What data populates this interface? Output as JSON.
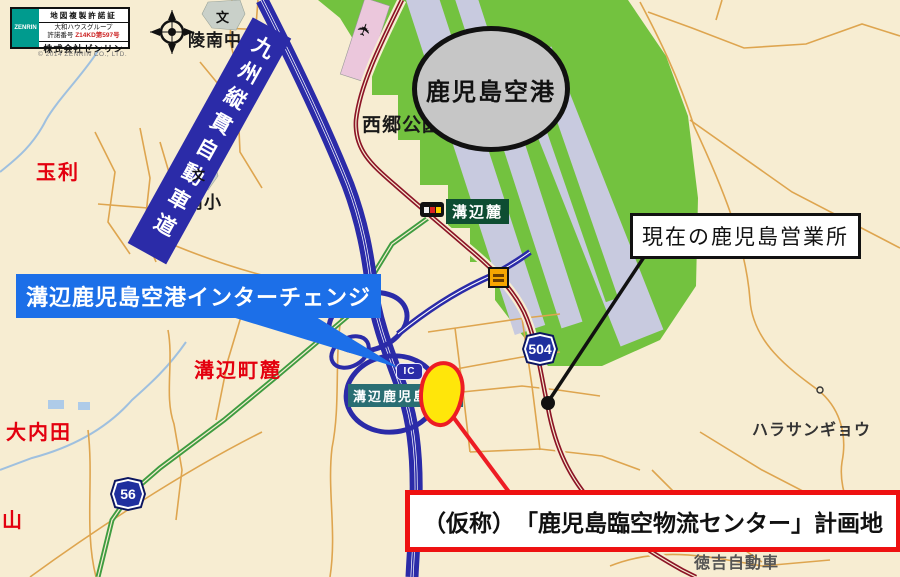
{
  "license_box": {
    "logo": "ZENRIN",
    "title": "地図複製許諾証",
    "group_name": "大和ハウスグループ",
    "license_label": "許諾番号",
    "license_number": "Z14KD第597号",
    "company": "株式会社ゼンリン",
    "copyright": "© 2014 ZENRIN CO., LTD."
  },
  "callouts": {
    "airport": "鹿児島空港",
    "expressway_banner": "九州縦貫自動車道",
    "interchange": "溝辺鹿児島空港インターチェンジ",
    "interchange_map_label": "溝辺鹿児島空港",
    "ic_badge": "IC",
    "current_office": "現在の鹿児島営業所",
    "planned_site": "（仮称）　「鹿児島臨空物流センター」計画地"
  },
  "places": {
    "tamari": "玉利",
    "ryonan_junior_high": "陵南中",
    "ryonan_elementary": "陵南小",
    "saigo_park": "西郷公園",
    "mizobe_fumoto_stop": "溝辺麓",
    "mizobe_cho_fumoto": "溝辺町麓",
    "ouchida": "大内田",
    "yama": "山",
    "hara_sangyo": "ハラサンギョウ",
    "tokuyoshi_jidosha": "徳吉自動車",
    "school_mark": "文"
  },
  "route_shields": {
    "route504": "504",
    "route56": "56"
  },
  "icons": {
    "airplane": "✈"
  },
  "colors": {
    "map_background": "#F7EDD2",
    "airport_green": "#73C23F",
    "runway_gray": "#C8CADF",
    "expressway_blue": "#2B2BA8",
    "callout_blue": "#1C6FE8",
    "site_yellow": "#FFE60A",
    "alert_red": "#ED1C24",
    "road_red": "#8C1426",
    "place_red": "#E3000F"
  }
}
